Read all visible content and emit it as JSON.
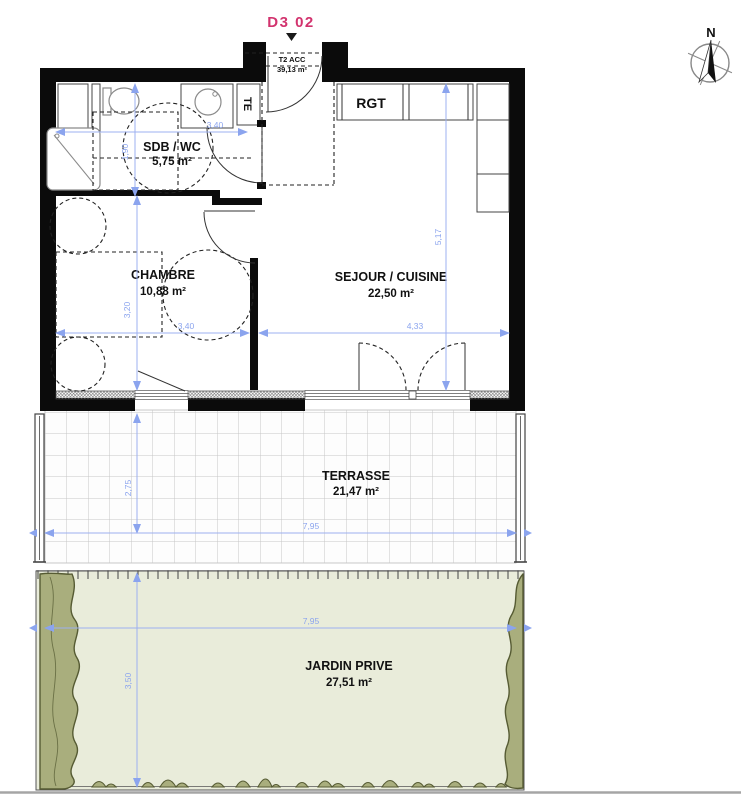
{
  "header": {
    "unit_code": "D3 02",
    "type_label": "T2 ACC",
    "total_area": "39,13 m²"
  },
  "compass": {
    "north_label": "N"
  },
  "rooms": {
    "sdb": {
      "name": "SDB / WC",
      "area": "5,75 m²"
    },
    "chambre": {
      "name": "CHAMBRE",
      "area": "10,88 m²"
    },
    "sejour": {
      "name": "SEJOUR / CUISINE",
      "area": "22,50 m²"
    },
    "rgt": {
      "name": "RGT"
    },
    "te": {
      "name": "TE"
    },
    "terrasse": {
      "name": "TERRASSE",
      "area": "21,47 m²"
    },
    "jardin": {
      "name": "JARDIN PRIVE",
      "area": "27,51 m²"
    }
  },
  "dimensions": {
    "sdb_width": "3,40",
    "sdb_depth": "1,90",
    "chambre_width": "3,40",
    "chambre_depth": "3,20",
    "sejour_width": "4,33",
    "sejour_depth": "5,17",
    "terrasse_depth": "2,75",
    "terrasse_width": "7,95",
    "jardin_width": "7,95",
    "jardin_depth": "3,50"
  },
  "colors": {
    "dimension_blue": "#8ba4ee",
    "unit_pink": "#d2336e",
    "wall_black": "#0b0b0b",
    "jardin_green": "#e9ecda",
    "bush_olive": "#a9ae7d",
    "bush_outline": "#565b33"
  }
}
